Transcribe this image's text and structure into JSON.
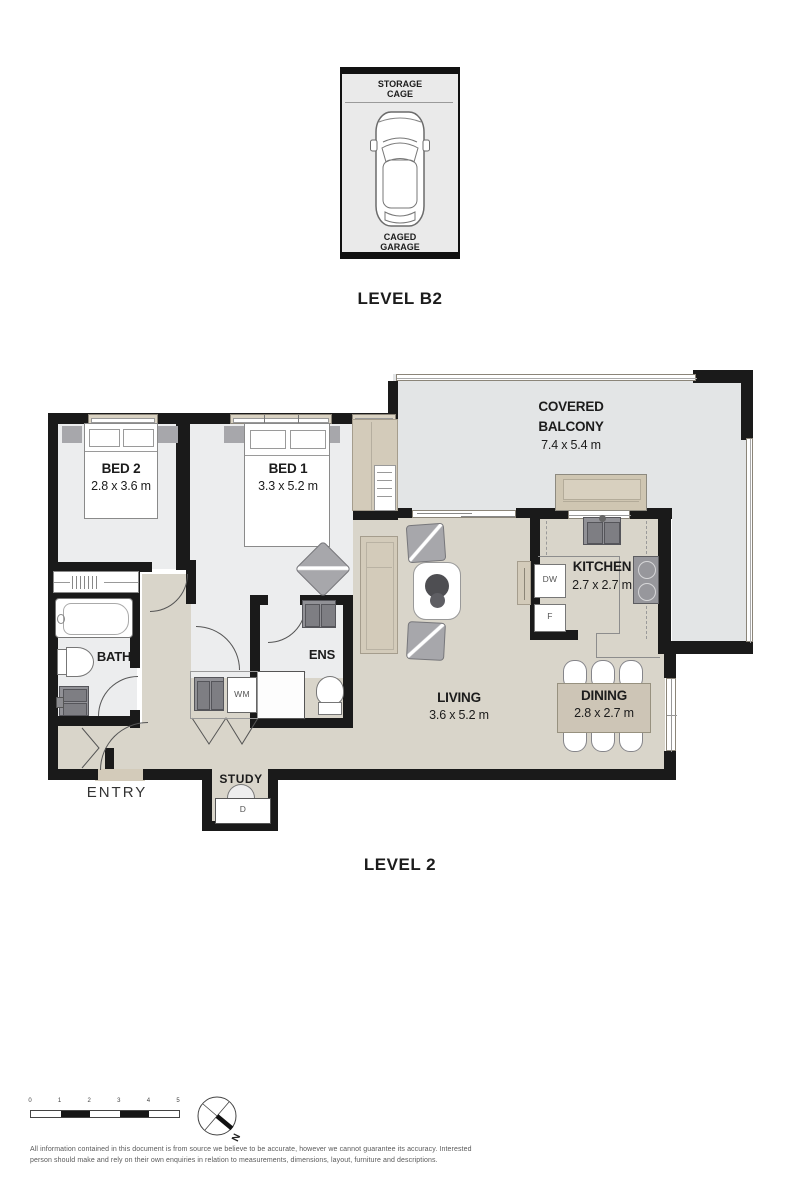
{
  "garage": {
    "storage_label": "STORAGE CAGE",
    "garage_label": "CAGED GARAGE",
    "level_label": "LEVEL B2"
  },
  "floorplan": {
    "level_label": "LEVEL 2",
    "rooms": {
      "balcony": {
        "name": "COVERED BALCONY",
        "dims": "7.4 x 5.4 m"
      },
      "bed2": {
        "name": "BED 2",
        "dims": "2.8 x 3.6 m"
      },
      "bed1": {
        "name": "BED 1",
        "dims": "3.3 x 5.2 m"
      },
      "kitchen": {
        "name": "KITCHEN",
        "dims": "2.7 x 2.7 m"
      },
      "living": {
        "name": "LIVING",
        "dims": "3.6 x 5.2 m"
      },
      "dining": {
        "name": "DINING",
        "dims": "2.8 x 2.7 m"
      },
      "bath": {
        "name": "BATH"
      },
      "ens": {
        "name": "ENS"
      },
      "study": {
        "name": "STUDY"
      },
      "entry": {
        "name": "ENTRY"
      }
    },
    "appliances": {
      "dishwasher": "DW",
      "fridge": "F",
      "washing_machine": "WM",
      "desk": "D"
    }
  },
  "footer": {
    "scale_ticks": [
      "0",
      "1",
      "2",
      "3",
      "4",
      "5"
    ],
    "compass_label": "N",
    "disclaimer_line1": "All information contained in this document is from source we believe to be accurate, however we cannot guarantee its accuracy. Interested",
    "disclaimer_line2": "person should make and rely on their own enquiries in relation to measurements, dimensions, layout, furniture and descriptions."
  },
  "colors": {
    "wall": "#1a1a1a",
    "floor_bedrooms": "#ecedee",
    "floor_living": "#d9d5ca",
    "floor_balcony": "#e3e5e6",
    "furniture_tan": "#d3cbba",
    "furniture_gray": "#a7a7ab"
  }
}
